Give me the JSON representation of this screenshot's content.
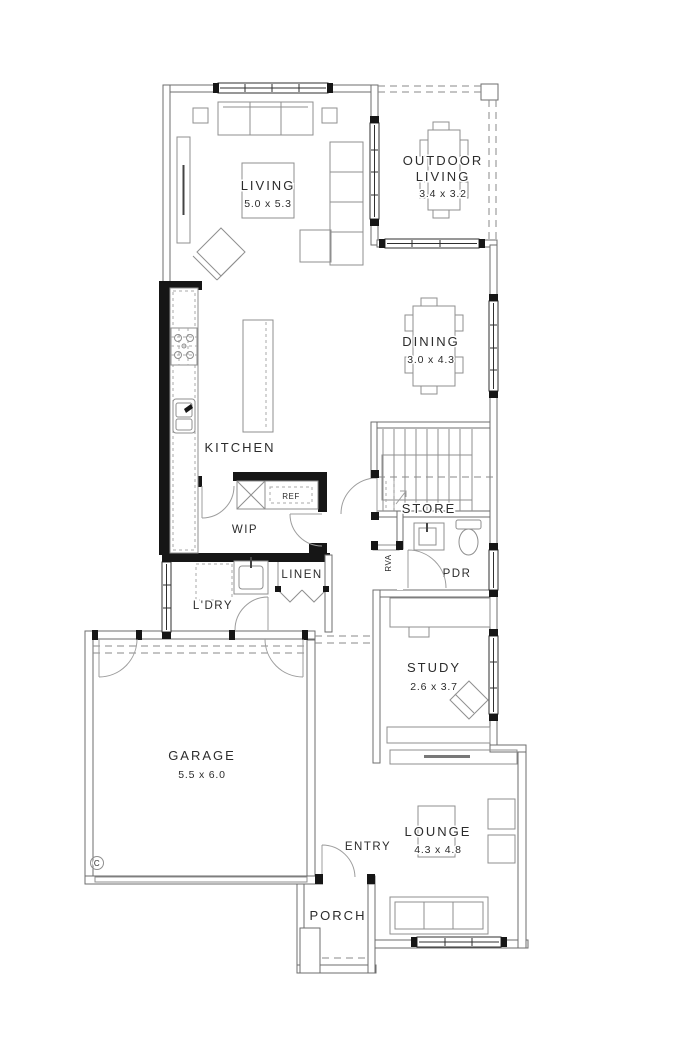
{
  "colors": {
    "background": "#ffffff",
    "wall_line": "#6e6e6e",
    "solid_wall": "#161616",
    "furniture_line": "#8f8f8f",
    "text": "#2c2c2c"
  },
  "rooms": {
    "living": {
      "label": "LIVING",
      "dimensions": "5.0 x 5.3"
    },
    "outdoor_living": {
      "label_line1": "OUTDOOR",
      "label_line2": "LIVING",
      "dimensions": "3.4 x 3.2"
    },
    "dining": {
      "label": "DINING",
      "dimensions": "3.0 x 4.3"
    },
    "kitchen": {
      "label": "KITCHEN"
    },
    "wip": {
      "label": "WIP"
    },
    "store": {
      "label": "STORE"
    },
    "pdr": {
      "label": "PDR"
    },
    "linen": {
      "label": "LINEN"
    },
    "laundry": {
      "label": "L'DRY"
    },
    "study": {
      "label": "STUDY",
      "dimensions": "2.6 x 3.7"
    },
    "garage": {
      "label": "GARAGE",
      "dimensions": "5.5 x 6.0"
    },
    "entry": {
      "label": "ENTRY"
    },
    "lounge": {
      "label": "LOUNGE",
      "dimensions": "4.3 x 4.8"
    },
    "porch": {
      "label": "PORCH"
    }
  },
  "annotations": {
    "fridge": "REF",
    "return_air_vent": "RVA",
    "column_marker": "C"
  }
}
